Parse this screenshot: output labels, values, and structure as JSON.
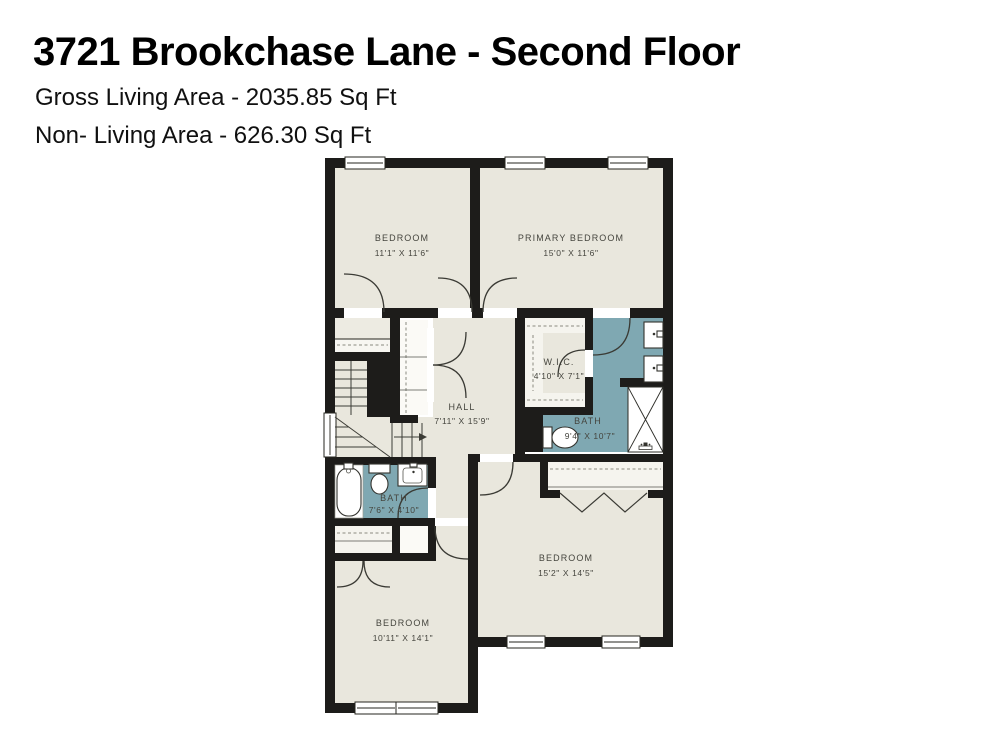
{
  "header": {
    "title": "3721 Brookchase Lane - Second Floor",
    "gross_living_area": "Gross Living Area - 2035.85 Sq Ft",
    "non_living_area": "Non- Living Area - 626.30 Sq Ft"
  },
  "rooms": [
    {
      "id": "bedroom-top-left",
      "name": "BEDROOM",
      "dims": "11'1\" X 11'6\""
    },
    {
      "id": "primary-bedroom",
      "name": "PRIMARY BEDROOM",
      "dims": "15'0\" X 11'6\""
    },
    {
      "id": "hall",
      "name": "HALL",
      "dims": "7'11\" X 15'9\""
    },
    {
      "id": "walk-in-closet",
      "name": "W.I.C.",
      "dims": "4'10\" X 7'1\""
    },
    {
      "id": "primary-bath",
      "name": "BATH",
      "dims": "9'4\" X 10'7\""
    },
    {
      "id": "hall-bath",
      "name": "BATH",
      "dims": "7'6\" X 4'10\""
    },
    {
      "id": "bedroom-bottom-left",
      "name": "BEDROOM",
      "dims": "10'11\" X 14'1\""
    },
    {
      "id": "bedroom-bottom-right",
      "name": "BEDROOM",
      "dims": "15'2\" X 14'5\""
    }
  ],
  "colors": {
    "wall": "#1d1c1a",
    "living_floor": "#e9e7dd",
    "bath_floor": "#7fa8b2",
    "closet_floor": "#f5f4ee",
    "label_text": "#45453e",
    "background": "#ffffff"
  }
}
